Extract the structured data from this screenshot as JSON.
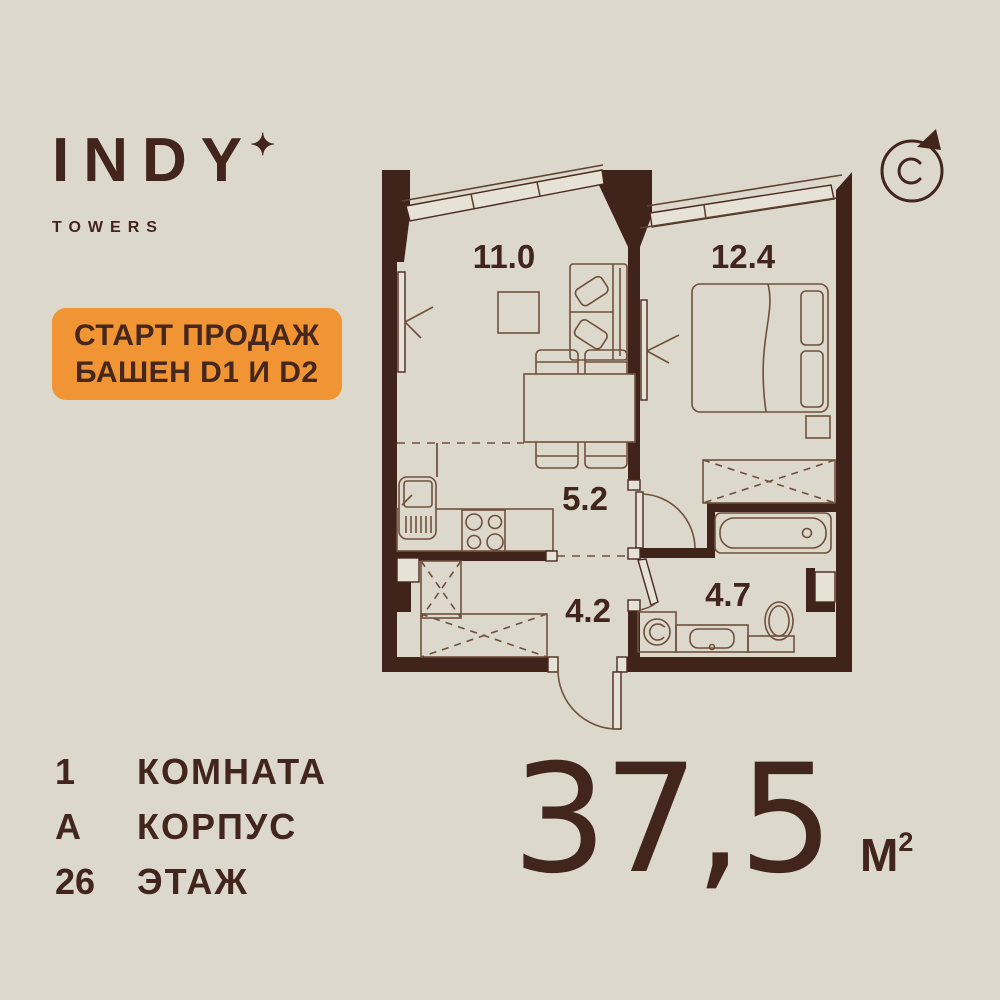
{
  "brand": {
    "name": "INDY",
    "star": "✦",
    "subtitle": "TOWERS"
  },
  "badge": {
    "line1": "СТАРТ ПРОДАЖ",
    "line2": "БАШЕН D1 И D2"
  },
  "compass": {
    "north_letter": "С"
  },
  "plan": {
    "room_labels": {
      "living": "11.0",
      "bedroom": "12.4",
      "kitchen_corridor": "5.2",
      "hallway": "4.2",
      "bathroom": "4.7"
    }
  },
  "details": {
    "rows": [
      {
        "value": "1",
        "label": "КОМНАТА"
      },
      {
        "value": "А",
        "label": "КОРПУС"
      },
      {
        "value": "26",
        "label": "ЭТАЖ"
      }
    ]
  },
  "area": {
    "value": "37,5",
    "unit_base": "М",
    "unit_sup": "2"
  },
  "colors": {
    "background": "#dcd8cb",
    "ink": "#42261d",
    "accent_orange": "#f09434",
    "furniture_line": "#6f503e"
  }
}
